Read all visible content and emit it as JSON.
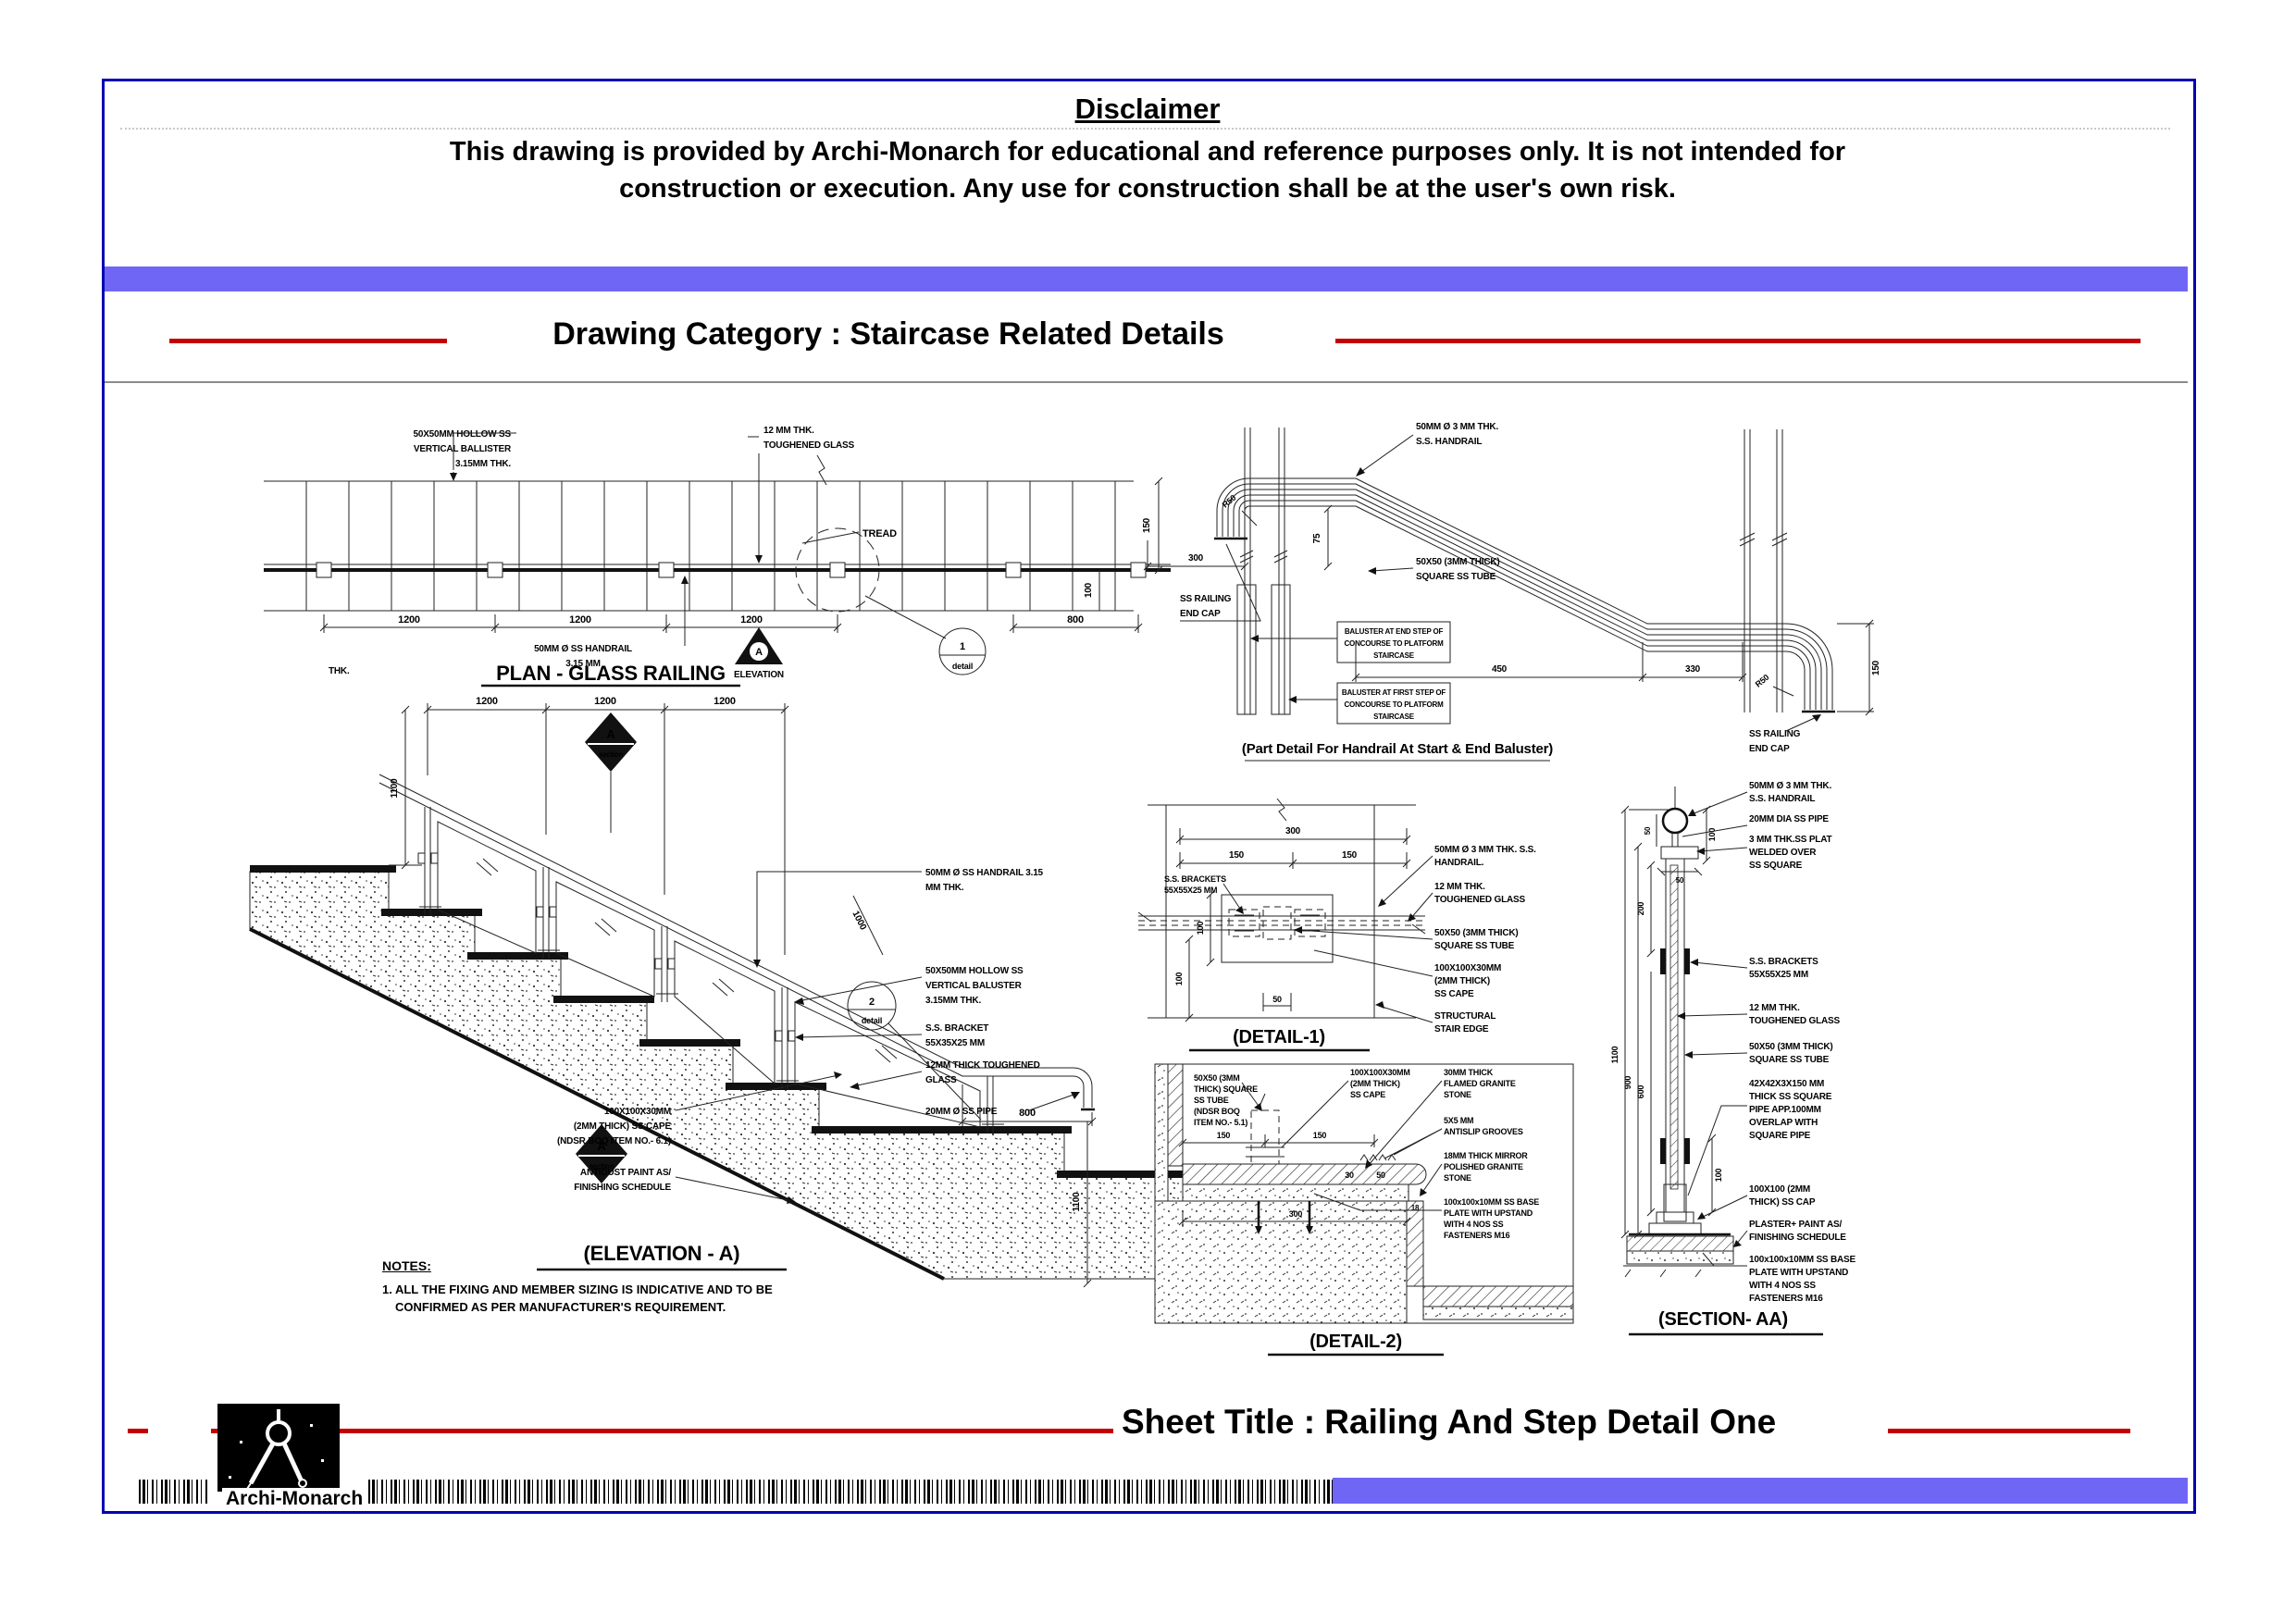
{
  "colors": {
    "border_blue": "#0000b2",
    "bar_purple": "#6f66f6",
    "accent_red": "#c40000"
  },
  "disclaimer": {
    "title": "Disclaimer",
    "line1": "This drawing is provided by Archi-Monarch for educational and reference purposes only. It is not intended for",
    "line2": "construction or execution. Any use for construction shall be at the user's own risk."
  },
  "category_heading": "Drawing Category : Staircase Related Details",
  "sheet_title": "Sheet Title : Railing And Step Detail One",
  "brand": "Archi-Monarch",
  "plan": {
    "title": "PLAN - GLASS RAILING",
    "baluster_label": [
      "50X50MM HOLLOW SS",
      "VERTICAL BALLISTER",
      "3.15MM THK."
    ],
    "glass_label": [
      "12 MM THK.",
      "TOUGHENED GLASS"
    ],
    "tread_label": "TREAD",
    "handrail_label": [
      "50MM Ø SS HANDRAIL",
      "3.15 MM"
    ],
    "thk_label": "THK.",
    "marker": {
      "letter": "A",
      "text": "ELEVATION"
    },
    "detail_bubble": {
      "num": "1",
      "text": "detail"
    },
    "dims": {
      "d1": "1200",
      "d2": "1200",
      "d3": "1200",
      "d4": "800",
      "d5": "150",
      "d6": "100"
    }
  },
  "part_detail": {
    "title": "(Part Detail For Handrail At Start & End Baluster)",
    "handrail_label": [
      "50MM Ø 3 MM THK.",
      "S.S. HANDRAIL"
    ],
    "tube_label": [
      "50X50 (3MM THICK)",
      "SQUARE SS TUBE"
    ],
    "endcap_left": [
      "SS RAILING",
      "END CAP"
    ],
    "endcap_right": [
      "SS RAILING",
      "END CAP"
    ],
    "box_end": [
      "BALUSTER AT END STEP OF",
      "CONCOURSE TO PLATFORM",
      "STAIRCASE"
    ],
    "box_first": [
      "BALUSTER AT FIRST STEP OF",
      "CONCOURSE TO PLATFORM",
      "STAIRCASE"
    ],
    "dims": {
      "d300": "300",
      "d75": "75",
      "d450": "450",
      "d330": "330",
      "d150": "150",
      "r50_left": "R50",
      "r50_right": "R50"
    }
  },
  "elevation": {
    "title": "(ELEVATION - A)",
    "dims": {
      "t1": "1200",
      "t2": "1200",
      "t3": "1200",
      "left": "1100",
      "glass": "1000",
      "d800": "800",
      "right": "1100"
    },
    "marker_top": {
      "letter": "A",
      "text": "section"
    },
    "marker_bottom": {
      "letter": "A",
      "text": "section"
    },
    "labels": {
      "handrail": [
        "50MM Ø SS HANDRAIL 3.15",
        "MM THK."
      ],
      "baluster": [
        "50X50MM HOLLOW SS",
        "VERTICAL BALUSTER",
        "3.15MM THK."
      ],
      "bracket": [
        "S.S. BRACKET",
        "55X35X25 MM"
      ],
      "glass": [
        "12MM THICK TOUGHENED",
        "GLASS"
      ],
      "pipe": "20MM Ø SS PIPE",
      "cape": [
        "100X100X30MM",
        "(2MM THICK) SS CAPE",
        "(NDSR BOQ ITEM NO.- 6.1)"
      ],
      "antidust": [
        "ANTIDUST PAINT AS/",
        "FINISHING SCHEDULE"
      ]
    },
    "detail_bubble": {
      "num": "2",
      "text": "detail"
    }
  },
  "notes": {
    "heading": "NOTES:",
    "line1": "1. ALL THE FIXING AND MEMBER SIZING IS INDICATIVE AND TO BE",
    "line2": "CONFIRMED AS PER MANUFACTURER'S REQUIREMENT."
  },
  "detail1": {
    "title": "(DETAIL-1)",
    "dims": {
      "d300": "300",
      "d150a": "150",
      "d150b": "150",
      "d100a": "100",
      "d100b": "100",
      "d50": "50"
    },
    "brackets_label": [
      "S.S. BRACKETS",
      "55X55X25 MM"
    ],
    "labels": {
      "handrail": [
        "50MM Ø 3 MM THK. S.S.",
        "HANDRAIL."
      ],
      "glass": [
        "12 MM THK.",
        "TOUGHENED GLASS"
      ],
      "tube": [
        "50X50 (3MM THICK)",
        "SQUARE SS TUBE"
      ],
      "cape": [
        "100X100X30MM",
        "(2MM THICK)",
        "SS CAPE"
      ],
      "edge": [
        "STRUCTURAL",
        "STAIR EDGE"
      ]
    }
  },
  "detail2": {
    "title": "(DETAIL-2)",
    "dims": {
      "d150a": "150",
      "d150b": "150",
      "d30": "30",
      "d50": "50",
      "d300": "300",
      "d18": "18"
    },
    "labels": {
      "tube": [
        "50X50 (3MM",
        "THICK) SQUARE",
        "SS TUBE",
        "(NDSR BOQ",
        "ITEM NO.- 5.1)"
      ],
      "cape": [
        "100X100X30MM",
        "(2MM THICK)",
        "SS CAPE"
      ],
      "granite30": [
        "30MM THICK",
        "FLAMED GRANITE",
        "STONE"
      ],
      "antislip": [
        "5X5 MM",
        "ANTISLIP GROOVES"
      ],
      "granite18": [
        "18MM THICK MIRROR",
        "POLISHED GRANITE",
        "STONE"
      ],
      "baseplate": [
        "100x100x10MM SS BASE",
        "PLATE WITH UPSTAND",
        "WITH 4 NOS SS",
        "FASTENERS M16"
      ]
    }
  },
  "section_aa": {
    "title": "(SECTION- AA)",
    "dims": {
      "d1100": "1100",
      "d900": "900",
      "d600": "600",
      "d200": "200",
      "d100a": "100",
      "d100b": "100",
      "d50a": "50",
      "d50b": "50"
    },
    "labels": {
      "handrail": [
        "50MM Ø 3 MM THK.",
        "S.S. HANDRAIL"
      ],
      "pipe": "20MM DIA SS PIPE",
      "plate": [
        "3 MM THK.SS PLAT",
        "WELDED OVER",
        "SS SQUARE"
      ],
      "brackets": [
        "S.S. BRACKETS",
        "55X55X25 MM"
      ],
      "glass": [
        "12 MM THK.",
        "TOUGHENED GLASS"
      ],
      "tube": [
        "50X50 (3MM THICK)",
        "SQUARE SS TUBE"
      ],
      "pipe42": [
        "42X42X3X150 MM",
        "THICK SS SQUARE",
        "PIPE APP.100MM",
        "OVERLAP WITH",
        "SQUARE PIPE"
      ],
      "cap": [
        "100X100 (2MM",
        "THICK) SS CAP"
      ],
      "plaster": [
        "PLASTER+ PAINT AS/",
        "FINISHING SCHEDULE"
      ],
      "baseplate": [
        "100x100x10MM SS BASE",
        "PLATE WITH UPSTAND",
        "WITH 4 NOS SS",
        "FASTENERS M16"
      ]
    }
  }
}
